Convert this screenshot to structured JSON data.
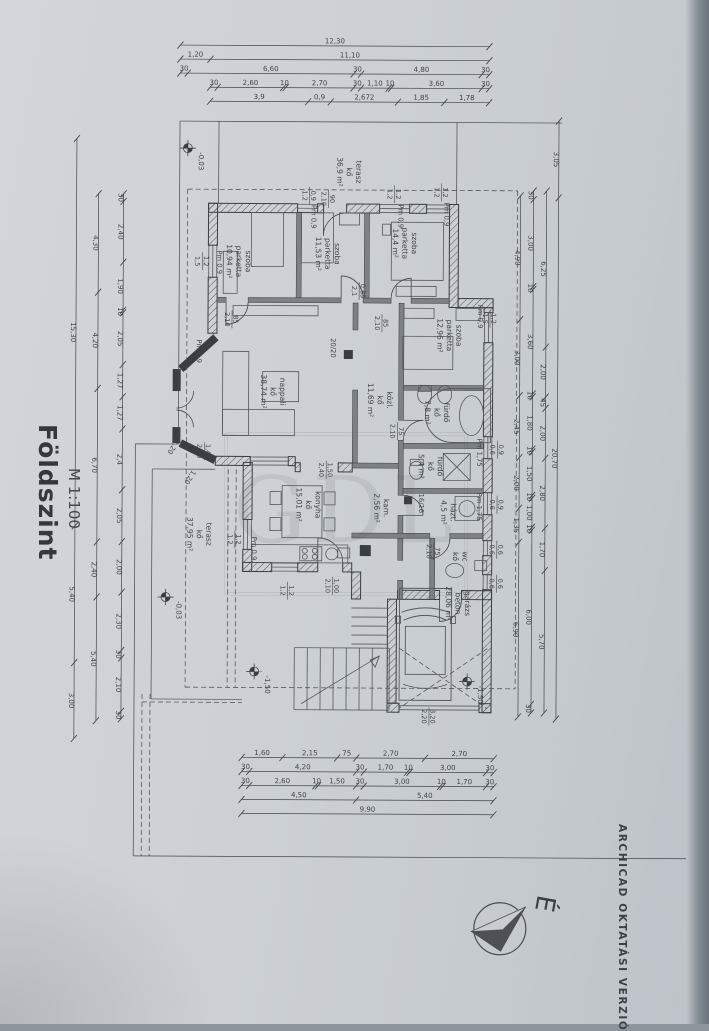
{
  "title": {
    "name": "Földszint",
    "scale": "M 1:100"
  },
  "edge_note": "ARCHICAD OKTATÁSI VERZIÓ",
  "compass": {
    "label": "É"
  },
  "watermark": "GDL",
  "rooms": [
    {
      "lines": [
        "terasz",
        "kő",
        "36,9 m²"
      ],
      "x": 345,
      "y": 172
    },
    {
      "lines": [
        "szoba",
        "parketta",
        "10,94 m²"
      ],
      "x": 235,
      "y": 262
    },
    {
      "lines": [
        "szoba",
        "parketta",
        "11,53 m²"
      ],
      "x": 324,
      "y": 254
    },
    {
      "lines": [
        "szoba",
        "parketta",
        "14,4 m²"
      ],
      "x": 401,
      "y": 243
    },
    {
      "lines": [
        "szoba",
        "parketta",
        "12,96 m²"
      ],
      "x": 446,
      "y": 335
    },
    {
      "lines": [
        "nappali",
        "kő",
        "38,74 m²"
      ],
      "x": 270,
      "y": 392
    },
    {
      "lines": [
        "közl.",
        "kő",
        "11,69 m²"
      ],
      "x": 377,
      "y": 400
    },
    {
      "lines": [
        "fürdő",
        "kő",
        "7,8 m²"
      ],
      "x": 434,
      "y": 412
    },
    {
      "lines": [
        "fürdő",
        "kő",
        "5,4 m²"
      ],
      "x": 428,
      "y": 466
    },
    {
      "lines": [
        "házt.",
        "4,5 m²"
      ],
      "x": 446,
      "y": 512
    },
    {
      "lines": [
        "wc",
        "kő"
      ],
      "x": 458,
      "y": 556
    },
    {
      "lines": [
        "kam.",
        "2,56 m²"
      ],
      "x": 379,
      "y": 508
    },
    {
      "lines": [
        "konyha",
        "kő",
        "15,01 m²"
      ],
      "x": 306,
      "y": 505
    },
    {
      "lines": [
        "terasz",
        "kő",
        "37,95 m²"
      ],
      "x": 197,
      "y": 535
    },
    {
      "lines": [
        "garázs",
        "beton",
        "28,06 m²"
      ],
      "x": 456,
      "y": 603
    }
  ],
  "levels": [
    {
      "v": "-0,03",
      "x": 186,
      "y": 149
    },
    {
      "v": "-0,03",
      "x": 166,
      "y": 598
    },
    {
      "v": "-1,50",
      "x": 255,
      "y": 672
    },
    {
      "v": "-1,50",
      "x": 468,
      "y": 681
    }
  ],
  "annotations": {
    "fracs": [
      {
        "a": "1,2",
        "b": "1,5",
        "x": 201,
        "y": 262
      },
      {
        "a": "0,9",
        "b": "1,2",
        "x": 308,
        "y": 196
      },
      {
        "a": "90",
        "b": "2,10",
        "x": 327,
        "y": 199
      },
      {
        "a": "1,2",
        "b": "1,2",
        "x": 393,
        "y": 194
      },
      {
        "a": "1,2",
        "b": "1,2",
        "x": 440,
        "y": 192
      },
      {
        "a": "1,2",
        "b": "1,5",
        "x": 489,
        "y": 318
      },
      {
        "a": "0,9",
        "b": "0,6",
        "x": 497,
        "y": 449
      },
      {
        "a": "0,9",
        "b": "0,6",
        "x": 497,
        "y": 504
      },
      {
        "a": "0,6",
        "b": "0,6",
        "x": 497,
        "y": 549
      },
      {
        "a": "0,6",
        "b": "0,6",
        "x": 497,
        "y": 583
      },
      {
        "a": "1,2",
        "b": "1,2",
        "x": 235,
        "y": 540
      },
      {
        "a": "1,2",
        "b": "1,2",
        "x": 288,
        "y": 591
      },
      {
        "a": "1,40",
        "b": "2,10",
        "x": 204,
        "y": 452
      },
      {
        "a": "0,85",
        "b": "2,1",
        "x": 358,
        "y": 291
      },
      {
        "a": "85",
        "b": "2,10",
        "x": 381,
        "y": 323
      },
      {
        "a": "85",
        "b": "2,10",
        "x": 231,
        "y": 320
      },
      {
        "a": "75",
        "b": "2,10",
        "x": 397,
        "y": 431
      },
      {
        "a": "75",
        "b": "2,10",
        "x": 434,
        "y": 551
      },
      {
        "a": "1,00",
        "b": "2,10",
        "x": 333,
        "y": 586
      },
      {
        "a": "1,50",
        "b": "2,40",
        "x": 326,
        "y": 470
      },
      {
        "a": "3,20",
        "b": "2,20",
        "x": 430,
        "y": 716
      }
    ],
    "pms": [
      {
        "t": "Pm 0,9",
        "x": 216,
        "y": 263
      },
      {
        "t": "Pm 0,9",
        "x": 310,
        "y": 217
      },
      {
        "t": "Pm 0,9",
        "x": 397,
        "y": 216
      },
      {
        "t": "Pm 0,9",
        "x": 443,
        "y": 214
      },
      {
        "t": "Pm 0,9",
        "x": 477,
        "y": 316
      },
      {
        "t": "Pm 1,75",
        "x": 477,
        "y": 452
      },
      {
        "t": "Pm 1,75",
        "x": 477,
        "y": 506
      },
      {
        "t": "Pm 0,9",
        "x": 252,
        "y": 549
      },
      {
        "t": "Pm 0,9",
        "x": 196,
        "y": 352
      }
    ],
    "texts": [
      {
        "t": "20/20",
        "x": 330,
        "y": 348,
        "rot": 90
      },
      {
        "t": "16/16",
        "x": 419,
        "y": 503,
        "rot": 90
      },
      {
        "t": "1,20",
        "x": 171,
        "y": 447,
        "rot": 122
      },
      {
        "t": "1,20",
        "x": 188,
        "y": 477,
        "rot": 122
      }
    ]
  },
  "dim_chains": {
    "top": [
      {
        "y": 46,
        "x0": 178,
        "x1": 487,
        "values": [
          "12,30"
        ]
      },
      {
        "y": 60,
        "x0": 178,
        "x1": 487,
        "values": [
          "1,20",
          "11,10"
        ]
      },
      {
        "y": 74,
        "x0": 178,
        "x1": 487,
        "values": [
          "30",
          "6,60",
          "30",
          "4,80",
          "30"
        ]
      },
      {
        "y": 88,
        "x0": 208,
        "x1": 487,
        "values": [
          "30",
          "2,60",
          "10",
          "2,70",
          "30",
          "1,10",
          "10",
          "3,60",
          "30"
        ]
      },
      {
        "y": 102,
        "x0": 208,
        "x1": 487,
        "values": [
          "3,9",
          "0,9",
          "2,672",
          "1,85",
          "1,78"
        ]
      }
    ],
    "bottom": [
      {
        "y": 758,
        "x0": 243,
        "x1": 495,
        "values": [
          "1,60",
          "2,15",
          "75",
          "2,70",
          "2,70"
        ]
      },
      {
        "y": 772,
        "x0": 243,
        "x1": 495,
        "values": [
          "30",
          "4,20",
          "30",
          "1,70",
          "10",
          "3,00",
          "30"
        ]
      },
      {
        "y": 786,
        "x0": 243,
        "x1": 495,
        "values": [
          "30",
          "2,60",
          "10",
          "1,50",
          "30",
          "3,00",
          "10",
          "1,70",
          "30"
        ]
      },
      {
        "y": 800,
        "x0": 243,
        "x1": 495,
        "values": [
          "4,50",
          "5,40"
        ]
      },
      {
        "y": 814,
        "x0": 243,
        "x1": 495,
        "values": [
          "9,90"
        ]
      }
    ],
    "right": [
      {
        "x": 519,
        "y0": 195,
        "y1": 716,
        "values": [
          "4,90",
          "3,00",
          "2,45",
          "2,00",
          "1,35",
          "6,90"
        ]
      },
      {
        "x": 532,
        "y0": 190,
        "y1": 712,
        "values": [
          "30",
          "3,00",
          "10",
          "3,60",
          "10",
          "1,80",
          "10",
          "1,50",
          "10",
          "1,00",
          "10",
          "6,00",
          "30"
        ]
      },
      {
        "x": 545,
        "y0": 190,
        "y1": 712,
        "values": [
          "6,25",
          "2,00",
          "45",
          "2,00",
          "2,80",
          "1,70",
          "5,70"
        ]
      },
      {
        "x": 557,
        "y0": 120,
        "y1": 718,
        "values": [
          "3,05",
          "20,70"
        ]
      }
    ],
    "left": [
      {
        "x": 122,
        "y0": 195,
        "y1": 720,
        "values": [
          "30",
          "2,40",
          "1,90",
          "10",
          "2,05",
          "1,27",
          "1,27",
          "2,4",
          "2,05",
          "2,00",
          "2,30",
          "30",
          "2,10",
          "30"
        ]
      },
      {
        "x": 97,
        "y0": 195,
        "y1": 722,
        "values": [
          "4,30",
          "4,20",
          "6,70",
          "2,40",
          "5,40"
        ]
      },
      {
        "x": 75,
        "y0": 140,
        "y1": 740,
        "values": [
          "15,30",
          "5,40",
          "3,00"
        ]
      }
    ]
  }
}
